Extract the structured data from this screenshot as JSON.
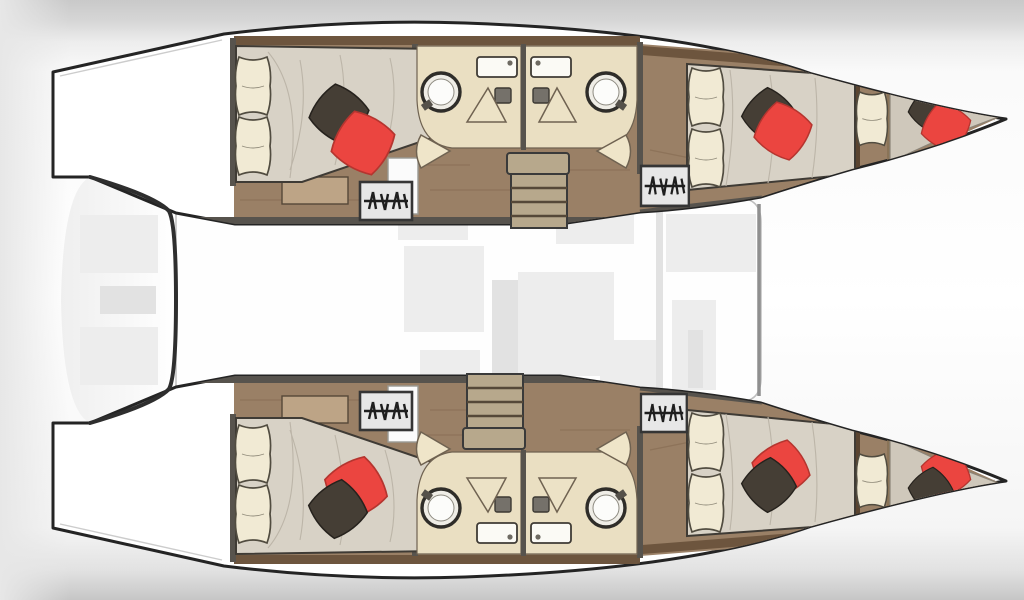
{
  "diagram": {
    "label": "Catamaran yacht deck floor plan, top-down view",
    "type": "boat-floor-plan",
    "hull_count": 2,
    "cabin_summary": "4 double cabins, 2 bow berths, 4 shower rooms with WC, central saloon, aft cockpit, 2 transom swim platforms"
  },
  "areas": {
    "port_hull": "Port hull (top)",
    "starboard_hull": "Starboard hull (bottom)",
    "saloon": "Central saloon deck",
    "cockpit": "Aft cockpit",
    "transom_port": "Port transom swim steps",
    "transom_starboard": "Starboard transom swim steps",
    "aft_cabin": "Aft double cabin",
    "fwd_cabin": "Forward double cabin",
    "bow_berth": "Bow berth",
    "bathroom_aft": "Aft shower room with WC",
    "bathroom_fwd": "Forward shower room with WC",
    "companionway": "Companionway steps icon",
    "stairs_port": "Port hull entry staircase",
    "stairs_starboard": "Starboard hull entry staircase"
  },
  "palette": {
    "outline": "#242424",
    "cockpit_edge": "#2e2e2e",
    "wall": "#57534d",
    "wall_wood": "#6d553e",
    "wood": "#9a8066",
    "wood_streak": "#84684f",
    "deck_line": "#bfbfbf",
    "stern_line": "#4a4a4a",
    "bed_quilt": "#d8d2c6",
    "quilt_line": "#bcb5a8",
    "pillow": "#f1ead4",
    "pillow_line": "#514c40",
    "cushion_dark": "#453e35",
    "cushion_red": "#eb4540",
    "cushion_red_line": "#b5352f",
    "counter": "#eadfc2",
    "counter_line": "#6f6251",
    "fixture": "#fbfaf5",
    "fixture_line": "#3f3b35",
    "toilet": "#75716a",
    "shower_ring": "#2f2d29",
    "shower_fill": "#efede6",
    "stair_tread": "#b7a88c",
    "stair_line": "#554838",
    "steps_icon_bg": "#e7e7e7",
    "steps_icon_line": "#1e1e1e",
    "bench": "#bda486",
    "faint": "#ededed",
    "faint2": "#e2e2e2"
  }
}
